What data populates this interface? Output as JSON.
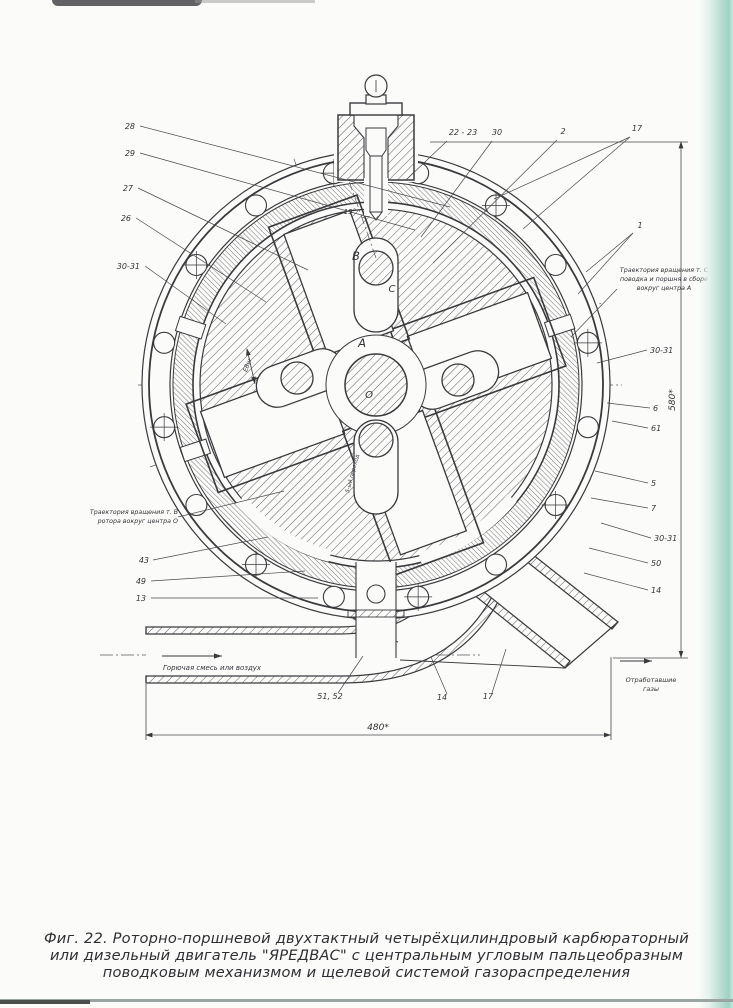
{
  "caption": {
    "line1": "Фиг. 22. Роторно-поршневой двухтактный четырёхцилиндровый карбюраторный",
    "line2": "или дизельный двигатель \"ЯРЕДВАС\" с центральным угловым пальцеобразным",
    "line3": "поводковым механизмом и щелевой системой газораспределения"
  },
  "dimensions": {
    "width": "480*",
    "height": "580*"
  },
  "flows": {
    "intake": "Горючая смесь или воздух",
    "exhaust_line1": "Отработавшие",
    "exhaust_line2": "газы"
  },
  "notes": {
    "left_line1": "Траектория вращения т. В",
    "left_line2": "ротора вокруг центра О",
    "right_line1": "Траектория вращения т. С",
    "right_line2": "поводка и поршня  в сборе",
    "right_line3": "вокруг центра А"
  },
  "points": {
    "A": "A",
    "B": "B",
    "C": "C",
    "O": "O"
  },
  "angle_label": "15°",
  "misc": {
    "ebsh": "ЕВш",
    "perekhod": "5-ый переход"
  },
  "part_labels": [
    {
      "t": "28",
      "x": 135,
      "y": 129,
      "a": "end",
      "lx": 140,
      "ly": 126,
      "targets": [
        [
          450,
          207
        ]
      ]
    },
    {
      "t": "29",
      "x": 135,
      "y": 156,
      "a": "end",
      "lx": 140,
      "ly": 153,
      "targets": [
        [
          415,
          230
        ]
      ]
    },
    {
      "t": "27",
      "x": 133,
      "y": 191,
      "a": "end",
      "lx": 138,
      "ly": 188,
      "targets": [
        [
          308,
          270
        ]
      ]
    },
    {
      "t": "26",
      "x": 131,
      "y": 221,
      "a": "end",
      "lx": 136,
      "ly": 218,
      "targets": [
        [
          266,
          302
        ]
      ]
    },
    {
      "t": "30-31",
      "x": 140,
      "y": 269,
      "a": "end",
      "lx": 145,
      "ly": 266,
      "targets": [
        [
          226,
          324
        ]
      ]
    },
    {
      "t": "43",
      "x": 149,
      "y": 563,
      "a": "end",
      "lx": 153,
      "ly": 560,
      "targets": [
        [
          268,
          537
        ]
      ]
    },
    {
      "t": "49",
      "x": 146,
      "y": 584,
      "a": "end",
      "lx": 151,
      "ly": 581,
      "targets": [
        [
          305,
          571
        ]
      ]
    },
    {
      "t": "13",
      "x": 146,
      "y": 601,
      "a": "end",
      "lx": 151,
      "ly": 598,
      "targets": [
        [
          318,
          598
        ]
      ]
    },
    {
      "t": "22 - 23",
      "x": 463,
      "y": 135,
      "a": "middle",
      "lx": 447,
      "ly": 141,
      "targets": [
        [
          406,
          180
        ]
      ]
    },
    {
      "t": "30",
      "x": 497,
      "y": 135,
      "a": "middle",
      "lx": 492,
      "ly": 141,
      "targets": [
        [
          421,
          237
        ]
      ]
    },
    {
      "t": "2",
      "x": 563,
      "y": 134,
      "a": "middle",
      "lx": 557,
      "ly": 140,
      "targets": [
        [
          433,
          263
        ]
      ]
    },
    {
      "t": "17",
      "x": 637,
      "y": 131,
      "a": "middle",
      "lx": 630,
      "ly": 137,
      "targets": [
        [
          523,
          229
        ],
        [
          494,
          199
        ]
      ]
    },
    {
      "t": "1",
      "x": 640,
      "y": 228,
      "a": "middle",
      "lx": 633,
      "ly": 233,
      "targets": [
        [
          586,
          272
        ],
        [
          578,
          294
        ]
      ]
    },
    {
      "t": "30-31",
      "x": 650,
      "y": 353,
      "a": "start",
      "lx": 647,
      "ly": 350,
      "targets": [
        [
          597,
          363
        ]
      ]
    },
    {
      "t": "6",
      "x": 653,
      "y": 411,
      "a": "start",
      "lx": 650,
      "ly": 408,
      "targets": [
        [
          607,
          403
        ]
      ]
    },
    {
      "t": "61",
      "x": 651,
      "y": 431,
      "a": "start",
      "lx": 648,
      "ly": 428,
      "targets": [
        [
          612,
          421
        ]
      ]
    },
    {
      "t": "5",
      "x": 651,
      "y": 486,
      "a": "start",
      "lx": 648,
      "ly": 483,
      "targets": [
        [
          595,
          471
        ]
      ]
    },
    {
      "t": "7",
      "x": 651,
      "y": 511,
      "a": "start",
      "lx": 648,
      "ly": 508,
      "targets": [
        [
          591,
          498
        ]
      ]
    },
    {
      "t": "30-31",
      "x": 654,
      "y": 541,
      "a": "start",
      "lx": 651,
      "ly": 538,
      "targets": [
        [
          601,
          523
        ]
      ]
    },
    {
      "t": "50",
      "x": 651,
      "y": 566,
      "a": "start",
      "lx": 648,
      "ly": 563,
      "targets": [
        [
          589,
          548
        ]
      ]
    },
    {
      "t": "14",
      "x": 651,
      "y": 593,
      "a": "start",
      "lx": 648,
      "ly": 590,
      "targets": [
        [
          584,
          573
        ]
      ]
    },
    {
      "t": "51, 52",
      "x": 330,
      "y": 699,
      "a": "middle",
      "lx": 338,
      "ly": 693,
      "targets": [
        [
          363,
          656
        ]
      ]
    },
    {
      "t": "14",
      "x": 442,
      "y": 700,
      "a": "middle",
      "lx": 447,
      "ly": 694,
      "targets": [
        [
          431,
          657
        ]
      ]
    },
    {
      "t": "17",
      "x": 488,
      "y": 699,
      "a": "middle",
      "lx": 492,
      "ly": 693,
      "targets": [
        [
          506,
          649
        ]
      ]
    }
  ]
}
